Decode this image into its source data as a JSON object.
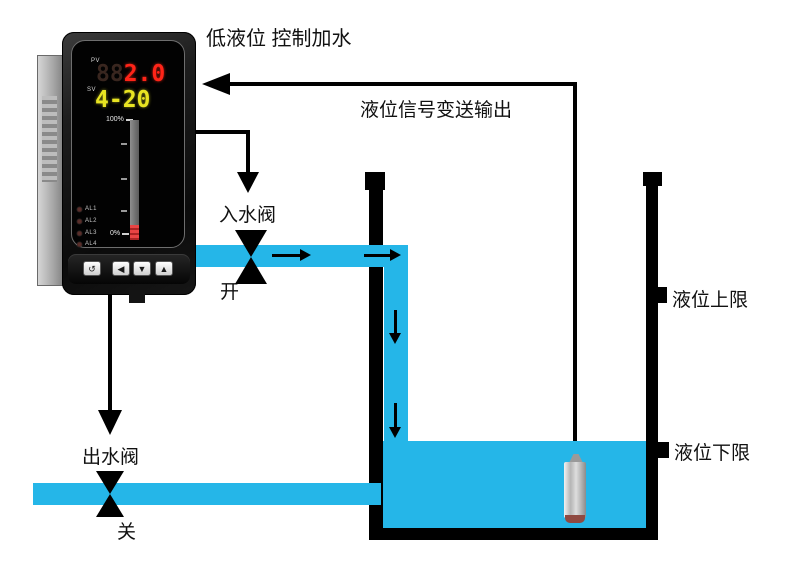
{
  "colors": {
    "water": "#25b6e8",
    "pv_red": "#ff2418",
    "sv_yellow": "#e8e422"
  },
  "title": "低液位 控制加水",
  "signal": {
    "label": "液位信号变送输出"
  },
  "meter": {
    "pv_label": "PV",
    "pv_ghost": "88",
    "pv_value": "2.0",
    "sv_label": "SV",
    "sv_value": "4-20",
    "bar_top_label": "100%",
    "bar_bottom_label": "0%",
    "alarms": [
      {
        "label": "AL1"
      },
      {
        "label": "AL2"
      },
      {
        "label": "AL3"
      },
      {
        "label": "AL4"
      }
    ],
    "buttons": [
      {
        "name": "set-button",
        "glyph": "↺"
      },
      {
        "name": "left-button",
        "glyph": "◀"
      },
      {
        "name": "down-button",
        "glyph": "▼"
      },
      {
        "name": "up-button",
        "glyph": "▲"
      }
    ]
  },
  "inlet_valve": {
    "label": "入水阀",
    "state": "开"
  },
  "outlet_valve": {
    "label": "出水阀",
    "state": "关"
  },
  "tank": {
    "upper_limit_label": "液位上限",
    "lower_limit_label": "液位下限"
  }
}
